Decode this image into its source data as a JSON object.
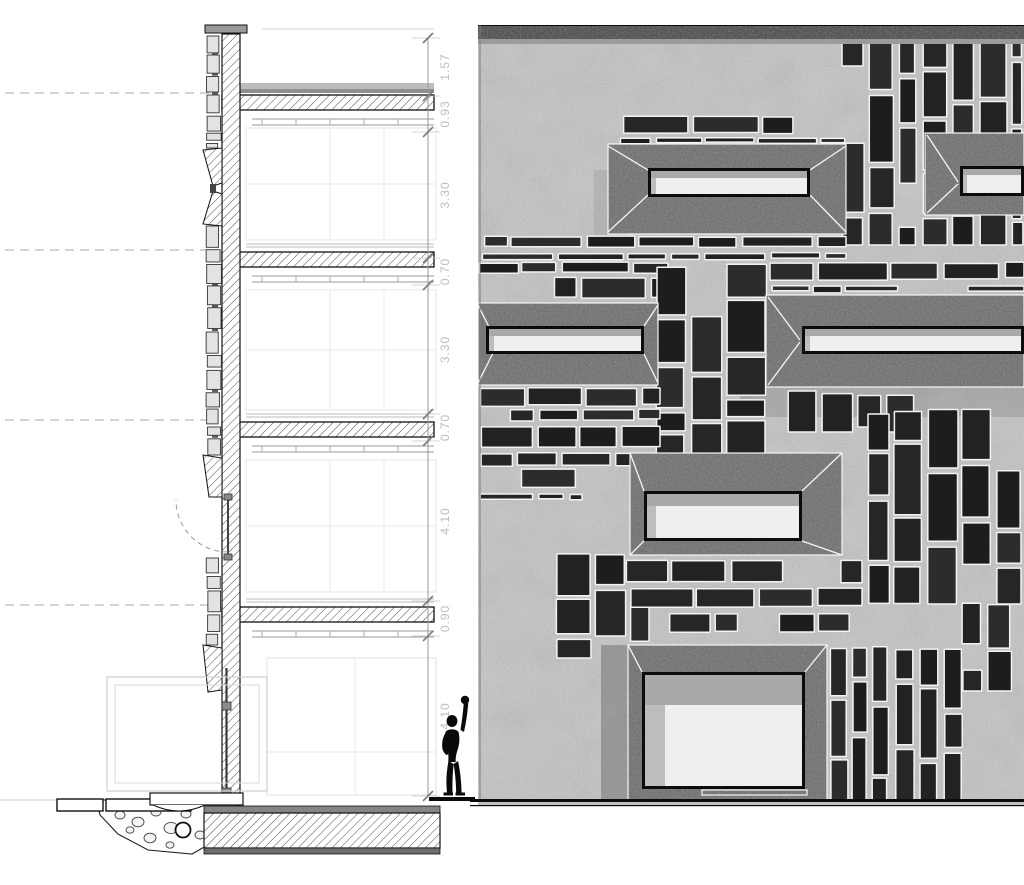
{
  "drawing": {
    "kind": "architectural wall section and stone facade elevation",
    "left_panel": "vertical wall section detail with floor slabs, stone cladding and dimension chain",
    "right_panel": "facade elevation with random stone cladding and deep splayed windows",
    "scale_figure": "modulor man silhouette with raised arm"
  },
  "colors": {
    "paper": "#ffffff",
    "line_dark": "#111111",
    "line_mid": "#666666",
    "line_light": "#cccccc",
    "dashed_level": "#a8a8a8",
    "dim_text": "#bdbdbd",
    "dim_tick": "#7a7a7a",
    "concrete_light": "#c3c3c3",
    "band_dark": "#474747",
    "reveal_gray": "#6d6d6d",
    "stone_darks": [
      "#1d1d1d",
      "#262626",
      "#2c2c2c",
      "#222222"
    ],
    "mortar_white": "#f3f3f3",
    "glass_light": "#eef0f0",
    "glass_shadow": "#a9a9a9",
    "frame_black": "#0c0c0c",
    "cladding_fill": "#e3e3e3",
    "figure_black": "#0a0a0a"
  },
  "section": {
    "level_lines_y": [
      93,
      250,
      420,
      605
    ],
    "slab_right_x": 434,
    "wall": {
      "x": 222,
      "w": 18,
      "top": 34,
      "bottom": 800
    },
    "cladding_segments": [
      [
        36,
        92
      ],
      [
        95,
        148
      ],
      [
        226,
        455
      ],
      [
        558,
        645
      ]
    ],
    "reveals": {
      "slot_window": [
        148,
        226
      ],
      "upper_head": [
        455,
        497
      ],
      "ground_head": [
        645,
        692
      ]
    },
    "glazing": {
      "casement": [
        497,
        558
      ],
      "ground_mullion": [
        668,
        795
      ]
    },
    "dimension_line": {
      "x": 428,
      "ticks_y": [
        38,
        96,
        132,
        258,
        285,
        414,
        441,
        601,
        636,
        796
      ],
      "labels": [
        "1.57",
        "0.93",
        "3.30",
        "0.70",
        "3.30",
        "0.70",
        "4.10",
        "0.90",
        "4.10"
      ]
    }
  },
  "elevation": {
    "frame": {
      "x": 478,
      "y": 25,
      "w": 546,
      "h": 781
    },
    "top_band": {
      "y": 26,
      "h": 13
    },
    "ground_line_y": 800,
    "windows": [
      {
        "id": "slot-upper-left",
        "surround": [
          608,
          144,
          238,
          90
        ],
        "frame": [
          648,
          168,
          162,
          29
        ],
        "top_band": 7,
        "left_band": 5,
        "diag": [
          [
            608,
            146,
            648,
            170
          ],
          [
            608,
            232,
            648,
            195
          ],
          [
            846,
            146,
            810,
            170
          ],
          [
            846,
            232,
            810,
            195
          ]
        ]
      },
      {
        "id": "slot-mid-left-edge",
        "surround": [
          478,
          303,
          180,
          82
        ],
        "frame": [
          486,
          326,
          158,
          28
        ],
        "top_band": 7,
        "left_band": 5,
        "diag": [
          [
            478,
            305,
            497,
            343
          ],
          [
            478,
            383,
            497,
            345
          ],
          [
            658,
            305,
            644,
            326
          ],
          [
            658,
            383,
            644,
            354
          ]
        ]
      },
      {
        "id": "slot-mid-right-edge",
        "surround": [
          766,
          295,
          258,
          92
        ],
        "frame": [
          802,
          326,
          222,
          28
        ],
        "top_band": 7,
        "left_band": 5,
        "diag": [
          [
            768,
            297,
            800,
            340
          ],
          [
            768,
            385,
            800,
            342
          ]
        ],
        "shadow_below": [
          740,
          387,
          284,
          30
        ]
      },
      {
        "id": "slot-top-right-edge",
        "surround": [
          925,
          133,
          99,
          82
        ],
        "frame": [
          960,
          166,
          64,
          30
        ],
        "top_band": 6,
        "left_band": 4,
        "diag": [
          [
            927,
            135,
            958,
            182
          ],
          [
            927,
            213,
            958,
            184
          ]
        ]
      },
      {
        "id": "window-center",
        "surround": [
          630,
          453,
          212,
          102
        ],
        "frame": [
          644,
          491,
          158,
          50
        ],
        "top_band": 12,
        "left_band": 9,
        "diag": [
          [
            630,
            453,
            644,
            491
          ],
          [
            842,
            453,
            802,
            491
          ],
          [
            630,
            555,
            644,
            541
          ],
          [
            842,
            555,
            802,
            541
          ]
        ]
      },
      {
        "id": "window-ground-large",
        "surround": [
          628,
          645,
          199,
          155
        ],
        "frame": [
          642,
          672,
          163,
          117
        ],
        "top_band": 30,
        "left_band": 20,
        "diag": [
          [
            628,
            645,
            642,
            672
          ],
          [
            827,
            645,
            805,
            672
          ]
        ],
        "shadow_left": [
          601,
          645,
          27,
          155
        ],
        "sill": [
          702,
          790,
          105,
          5
        ]
      }
    ],
    "stone_patches": [
      {
        "x": 620,
        "y": 116,
        "w": 226,
        "h": 30,
        "o": "h"
      },
      {
        "x": 842,
        "y": 28,
        "w": 182,
        "h": 217,
        "o": "v"
      },
      {
        "x": 478,
        "y": 236,
        "w": 368,
        "h": 26,
        "o": "h"
      },
      {
        "x": 478,
        "y": 262,
        "w": 190,
        "h": 42,
        "o": "h"
      },
      {
        "x": 656,
        "y": 262,
        "w": 112,
        "h": 208,
        "o": "m"
      },
      {
        "x": 766,
        "y": 262,
        "w": 258,
        "h": 33,
        "o": "h"
      },
      {
        "x": 478,
        "y": 387,
        "w": 182,
        "h": 82,
        "o": "h"
      },
      {
        "x": 478,
        "y": 469,
        "w": 104,
        "h": 34,
        "o": "h"
      },
      {
        "x": 788,
        "y": 390,
        "w": 128,
        "h": 42,
        "o": "m"
      },
      {
        "x": 868,
        "y": 408,
        "w": 156,
        "h": 196,
        "o": "v"
      },
      {
        "x": 556,
        "y": 550,
        "w": 96,
        "h": 108,
        "o": "m"
      },
      {
        "x": 624,
        "y": 560,
        "w": 238,
        "h": 84,
        "o": "h"
      },
      {
        "x": 830,
        "y": 645,
        "w": 134,
        "h": 156,
        "o": "v"
      },
      {
        "x": 962,
        "y": 603,
        "w": 62,
        "h": 88,
        "o": "m"
      }
    ]
  },
  "figure": {
    "name": "modulor-man",
    "x": 429,
    "y": 688,
    "w": 46,
    "h": 112,
    "baseline": [
      429,
      797,
      46,
      4
    ]
  }
}
